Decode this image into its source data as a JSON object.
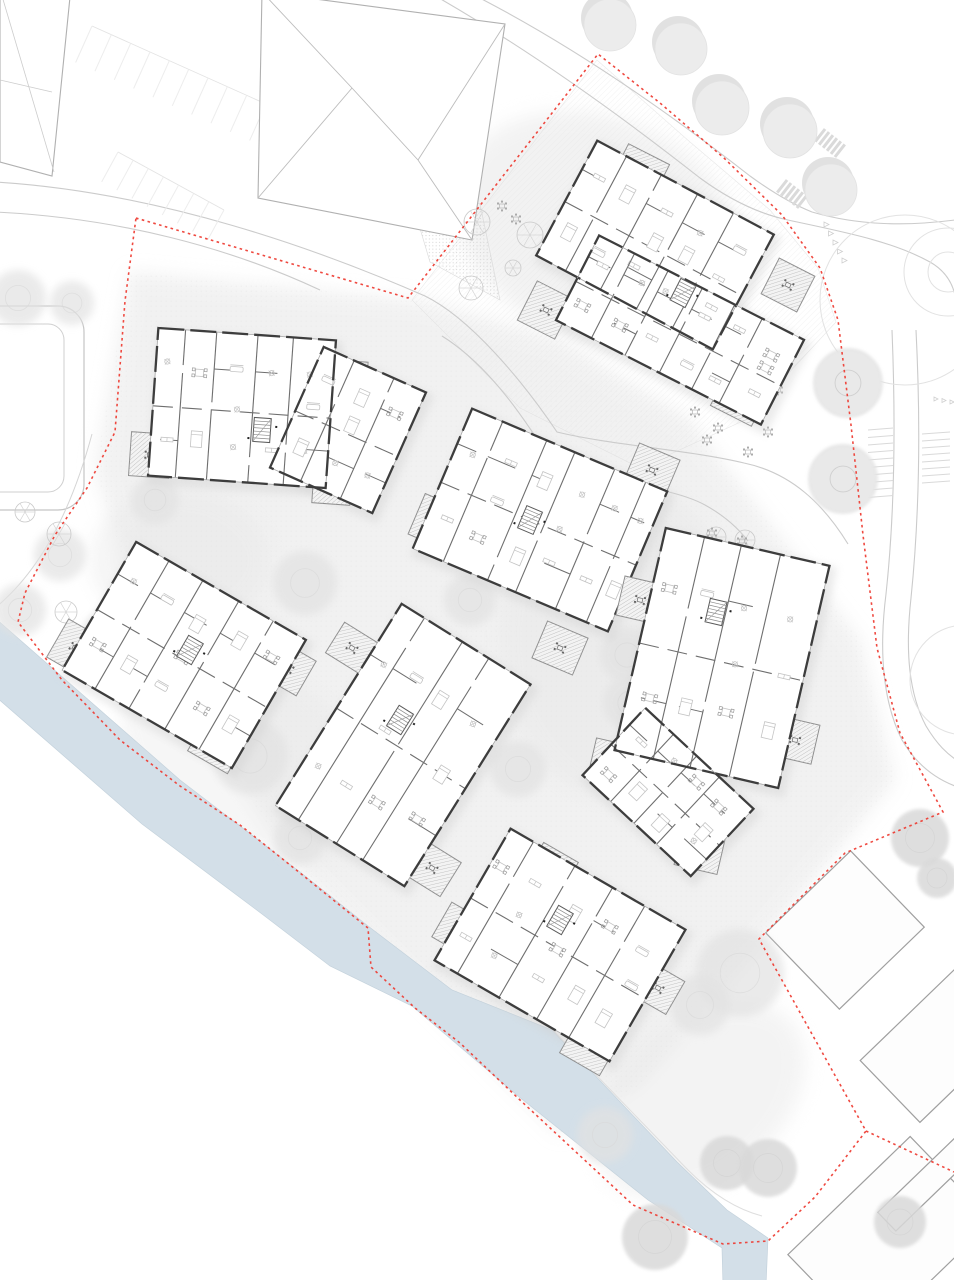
{
  "meta": {
    "title": "Residential quarter site plan – ground floor",
    "canvas": {
      "w": 954,
      "h": 1280
    }
  },
  "palette": {
    "bg": "#ffffff",
    "wash": "#e9e9e9",
    "road": "#cbcbcb",
    "faint": "#e3e3e3",
    "context": "#a3a3a3",
    "wall": "#3d3d3d",
    "partition": "#6e6e6e",
    "window": "#a5a5a5",
    "furniture": "#c4c4c4",
    "chair": "#9a9a9a",
    "balcony_hatch": "#b7b7b7",
    "balcony_edge": "#8f8f8f",
    "boundary": "#ee3a30",
    "canal": "#d3dfe8",
    "canal_edge": "#c4d2dc",
    "tree_row": "#ececec",
    "tree_shadow": "#d9d9d9",
    "tree_fluffy": "#e2e2e2",
    "tree_solid": "#d9d9d9",
    "tree_line": "#c9c9c9"
  },
  "boundary": {
    "points": [
      [
        136,
        218
      ],
      [
        408,
        298
      ],
      [
        598,
        54
      ],
      [
        660,
        103
      ],
      [
        724,
        158
      ],
      [
        782,
        215
      ],
      [
        820,
        268
      ],
      [
        838,
        320
      ],
      [
        851,
        425
      ],
      [
        863,
        535
      ],
      [
        877,
        648
      ],
      [
        900,
        733
      ],
      [
        930,
        788
      ],
      [
        943,
        812
      ],
      [
        845,
        853
      ],
      [
        759,
        939
      ],
      [
        866,
        1131
      ],
      [
        815,
        1197
      ],
      [
        768,
        1241
      ],
      [
        723,
        1244
      ],
      [
        633,
        1205
      ],
      [
        520,
        1100
      ],
      [
        460,
        1043
      ],
      [
        415,
        1008
      ],
      [
        371,
        967
      ],
      [
        368,
        928
      ],
      [
        300,
        873
      ],
      [
        240,
        825
      ],
      [
        180,
        786
      ],
      [
        120,
        740
      ],
      [
        62,
        680
      ],
      [
        18,
        622
      ],
      [
        25,
        593
      ],
      [
        55,
        535
      ],
      [
        87,
        488
      ],
      [
        115,
        432
      ],
      [
        125,
        301
      ]
    ],
    "extra_segments": [
      [
        [
          866,
          1131
        ],
        [
          954,
          1172
        ]
      ]
    ]
  },
  "canal": {
    "points": [
      [
        -5,
        618
      ],
      [
        180,
        780
      ],
      [
        300,
        872
      ],
      [
        368,
        926
      ],
      [
        452,
        990
      ],
      [
        552,
        1030
      ],
      [
        677,
        1162
      ],
      [
        727,
        1210
      ],
      [
        768,
        1238
      ],
      [
        766,
        1285
      ],
      [
        723,
        1285
      ],
      [
        722,
        1248
      ],
      [
        648,
        1200
      ],
      [
        518,
        1096
      ],
      [
        412,
        1006
      ],
      [
        330,
        966
      ],
      [
        262,
        914
      ],
      [
        142,
        824
      ],
      [
        -5,
        696
      ]
    ],
    "path_edge": "M545,1022 L688,1170 Q724,1206 762,1216"
  },
  "wash": {
    "main": [
      [
        130,
        272
      ],
      [
        420,
        300
      ],
      [
        560,
        340
      ],
      [
        690,
        420
      ],
      [
        860,
        640
      ],
      [
        895,
        780
      ],
      [
        770,
        935
      ],
      [
        640,
        1085
      ],
      [
        560,
        1135
      ],
      [
        430,
        1005
      ],
      [
        300,
        875
      ],
      [
        150,
        645
      ],
      [
        95,
        470
      ]
    ],
    "patches": [
      {
        "cx": 250,
        "cy": 760,
        "rx": 140,
        "ry": 90,
        "rot": 30,
        "op": 0.35
      },
      {
        "cx": 620,
        "cy": 640,
        "rx": 120,
        "ry": 160,
        "rot": 0,
        "op": 0.4
      },
      {
        "cx": 700,
        "cy": 1100,
        "rx": 120,
        "ry": 80,
        "rot": -40,
        "op": 0.45
      },
      {
        "cx": 180,
        "cy": 560,
        "rx": 90,
        "ry": 70,
        "rot": 0,
        "op": 0.4
      },
      {
        "cx": 600,
        "cy": 230,
        "rx": 150,
        "ry": 110,
        "rot": 25,
        "op": 0.5
      }
    ]
  },
  "garden_yard": [
    [
      412,
      300
    ],
    [
      597,
      60
    ],
    [
      690,
      142
    ],
    [
      770,
      210
    ],
    [
      818,
      268
    ],
    [
      836,
      322
    ],
    [
      745,
      420
    ],
    [
      640,
      468
    ],
    [
      520,
      408
    ]
  ],
  "gravel_strip": [
    [
      402,
      168
    ],
    [
      480,
      204
    ],
    [
      500,
      300
    ],
    [
      430,
      262
    ]
  ],
  "roads": [
    "M-5,182 C160,192 320,250 425,296 C470,318 522,380 557,432 C610,445 690,450 744,463 C792,473 824,505 848,544",
    "M-5,212 C120,218 230,248 320,290",
    "M442,336 C490,366 526,420 558,472 C612,483 672,487 705,505 C725,516 738,528 748,541",
    "M892,330 C896,430 894,520 886,594 C879,650 882,700 902,740 C916,764 934,778 955,786",
    "M916,330 C921,430 919,520 911,598 C905,652 909,694 926,726 C938,746 948,754 955,759",
    "M472,-6 C570,44 668,112 750,176 C772,192 792,204 812,212 C860,226 908,226 955,220",
    "M432,-6 C530,50 620,115 700,178 C730,200 760,214 788,220 C838,231 890,240 930,262 C944,270 952,282 955,295"
  ],
  "parking": {
    "east_left": {
      "x0": 868,
      "y0": 430,
      "x1": 893,
      "y1": 428,
      "count": 10,
      "step": 7.5
    },
    "east_right": {
      "x0": 922,
      "y0": 434,
      "x1": 950,
      "y1": 432,
      "count": 8,
      "step": 7
    },
    "northwest": [
      {
        "ax": 92,
        "ay": 26,
        "bx": 266,
        "by": 104,
        "count": 9,
        "len": 40
      },
      {
        "ax": 118,
        "ay": 152,
        "bx": 224,
        "by": 210,
        "count": 7,
        "len": 34
      }
    ]
  },
  "crosswalks": [
    {
      "cx": 830,
      "cy": 143,
      "rot": 38,
      "count": 6,
      "len": 16,
      "gap": 5
    },
    {
      "cx": 792,
      "cy": 194,
      "rot": 38,
      "count": 6,
      "len": 16,
      "gap": 5
    }
  ],
  "yield_rows": [
    {
      "x0": 824,
      "y0": 222,
      "x1": 842,
      "y1": 258,
      "count": 5,
      "size": 5
    },
    {
      "x0": 934,
      "y0": 397,
      "x1": 950,
      "y1": 400,
      "count": 3,
      "size": 4
    }
  ],
  "roundabout": {
    "circles": [
      {
        "cx": 948,
        "cy": 272,
        "r": 44
      },
      {
        "cx": 948,
        "cy": 272,
        "r": 20
      },
      {
        "cx": 905,
        "cy": 300,
        "r": 85
      },
      {
        "cx": 965,
        "cy": 680,
        "r": 55
      }
    ]
  },
  "sports_court": {
    "outer": {
      "x": -52,
      "y": 306,
      "w": 136,
      "h": 204,
      "rx": 26
    },
    "inner": {
      "x": -36,
      "y": 324,
      "w": 100,
      "h": 168,
      "rx": 16
    },
    "arc": "M-10,612 Q58,560 92,434"
  },
  "house": {
    "outline": [
      [
        262,
        -8
      ],
      [
        505,
        24
      ],
      [
        472,
        240
      ],
      [
        258,
        198
      ]
    ],
    "ridge": [
      [
        352,
        88
      ],
      [
        418,
        160
      ]
    ],
    "hips": [
      [
        [
          262,
          -8
        ],
        [
          352,
          88
        ]
      ],
      [
        [
          258,
          198
        ],
        [
          352,
          88
        ]
      ],
      [
        [
          505,
          24
        ],
        [
          418,
          160
        ]
      ],
      [
        [
          472,
          240
        ],
        [
          418,
          160
        ]
      ]
    ]
  },
  "corner_building": {
    "outline": [
      [
        0,
        -6
      ],
      [
        70,
        -3
      ],
      [
        52,
        176
      ],
      [
        0,
        162
      ]
    ],
    "lines": [
      [
        [
          2,
          -4
        ],
        [
          54,
          172
        ]
      ],
      [
        [
          0,
          80
        ],
        [
          52,
          92
        ]
      ]
    ]
  },
  "context_se": [
    {
      "cx": 845,
      "cy": 930,
      "w": 118,
      "h": 106,
      "rot": -44
    },
    {
      "cx": 962,
      "cy": 1022,
      "w": 200,
      "h": 86,
      "rot": -44
    },
    {
      "cx": 890,
      "cy": 1238,
      "w": 170,
      "h": 118,
      "rot": -44
    },
    {
      "cx": 930,
      "cy": 1180,
      "w": 120,
      "h": 26,
      "rot": -44
    }
  ],
  "trees": {
    "row": [
      [
        610,
        25,
        26
      ],
      [
        681,
        49,
        26
      ],
      [
        722,
        108,
        27
      ],
      [
        790,
        131,
        27
      ],
      [
        831,
        190,
        26
      ]
    ],
    "ring": [
      [
        848,
        383,
        34
      ],
      [
        843,
        479,
        34
      ]
    ],
    "fluffy": [
      [
        305,
        583,
        32
      ],
      [
        470,
        600,
        26
      ],
      [
        250,
        756,
        38
      ],
      [
        300,
        838,
        26
      ],
      [
        627,
        655,
        27
      ],
      [
        630,
        703,
        27
      ],
      [
        518,
        769,
        28
      ],
      [
        445,
        698,
        20
      ],
      [
        740,
        973,
        44
      ],
      [
        700,
        1005,
        30
      ],
      [
        605,
        1135,
        28
      ],
      [
        155,
        500,
        24
      ],
      [
        60,
        555,
        26
      ],
      [
        20,
        610,
        26
      ],
      [
        110,
        640,
        30
      ],
      [
        18,
        298,
        28
      ],
      [
        72,
        303,
        22
      ]
    ],
    "solid": [
      [
        655,
        1237,
        33
      ],
      [
        900,
        1222,
        26
      ],
      [
        920,
        838,
        29
      ],
      [
        937,
        878,
        20
      ],
      [
        727,
        1163,
        27
      ],
      [
        768,
        1168,
        29
      ]
    ],
    "line": [
      [
        530,
        235,
        13
      ],
      [
        477,
        222,
        13
      ],
      [
        471,
        288,
        12
      ],
      [
        513,
        268,
        8
      ],
      [
        716,
        537,
        10
      ],
      [
        745,
        540,
        10
      ],
      [
        59,
        534,
        12
      ],
      [
        25,
        512,
        10
      ],
      [
        66,
        612,
        11
      ]
    ]
  },
  "picnic_tables": [
    [
      695,
      412
    ],
    [
      718,
      428
    ],
    [
      737,
      372
    ],
    [
      768,
      432
    ],
    [
      748,
      452
    ],
    [
      628,
      492
    ],
    [
      502,
      206
    ],
    [
      516,
      219
    ],
    [
      712,
      533
    ],
    [
      742,
      541
    ],
    [
      778,
      390
    ],
    [
      707,
      440
    ]
  ],
  "buildings": [
    {
      "id": "north-east",
      "seed": 11,
      "volumes": [
        {
          "cx": 655,
          "cy": 245,
          "w": 200,
          "h": 130,
          "rot": 28
        },
        {
          "cx": 680,
          "cy": 330,
          "w": 230,
          "h": 95,
          "rot": 27
        }
      ],
      "balconies": [
        [
          640,
          172,
          46,
          40
        ],
        [
          546,
          310,
          42,
          44
        ],
        [
          788,
          285,
          40,
          40
        ],
        [
          740,
          398,
          46,
          40
        ]
      ],
      "stair": [
        683,
        293
      ],
      "rot": 27
    },
    {
      "id": "north-west",
      "seed": 23,
      "volumes": [
        {
          "cx": 242,
          "cy": 408,
          "w": 178,
          "h": 148,
          "rot": 4
        },
        {
          "cx": 348,
          "cy": 430,
          "w": 112,
          "h": 132,
          "rot": 24
        }
      ],
      "balconies": [
        [
          150,
          455,
          40,
          44
        ],
        [
          264,
          452,
          42,
          38
        ],
        [
          332,
          486,
          38,
          36
        ],
        [
          350,
          377,
          34,
          32
        ]
      ],
      "stair": [
        262,
        430
      ],
      "rot": 4
    },
    {
      "id": "centre",
      "seed": 37,
      "volumes": [
        {
          "cx": 540,
          "cy": 520,
          "w": 212,
          "h": 152,
          "rot": 23
        }
      ],
      "balconies": [
        [
          436,
          522,
          42,
          44
        ],
        [
          560,
          648,
          44,
          40
        ],
        [
          652,
          470,
          44,
          40
        ]
      ],
      "stair": [
        530,
        520
      ],
      "rot": 23
    },
    {
      "id": "west",
      "seed": 41,
      "volumes": [
        {
          "cx": 184,
          "cy": 655,
          "w": 196,
          "h": 148,
          "rot": 30
        }
      ],
      "balconies": [
        [
          75,
          648,
          40,
          44
        ],
        [
          140,
          580,
          38,
          36
        ],
        [
          218,
          744,
          46,
          42
        ],
        [
          288,
          668,
          42,
          40
        ]
      ],
      "stair": [
        190,
        650
      ],
      "rot": 30
    },
    {
      "id": "centre-south",
      "seed": 53,
      "volumes": [
        {
          "cx": 403,
          "cy": 745,
          "w": 152,
          "h": 238,
          "rot": 32
        }
      ],
      "balconies": [
        [
          352,
          648,
          40,
          36
        ],
        [
          470,
          700,
          38,
          36
        ],
        [
          330,
          800,
          40,
          38
        ],
        [
          432,
          868,
          44,
          40
        ]
      ],
      "stair": [
        400,
        720
      ],
      "rot": 32
    },
    {
      "id": "east",
      "seed": 67,
      "volumes": [
        {
          "cx": 722,
          "cy": 658,
          "w": 168,
          "h": 228,
          "rot": 13
        },
        {
          "cx": 668,
          "cy": 792,
          "w": 148,
          "h": 92,
          "rot": 43
        }
      ],
      "balconies": [
        [
          700,
          560,
          42,
          38
        ],
        [
          640,
          600,
          40,
          40
        ],
        [
          795,
          740,
          42,
          40
        ],
        [
          612,
          760,
          40,
          36
        ],
        [
          700,
          850,
          44,
          40
        ]
      ],
      "stair": [
        716,
        612
      ],
      "rot": 13
    },
    {
      "id": "south",
      "seed": 79,
      "volumes": [
        {
          "cx": 560,
          "cy": 945,
          "w": 202,
          "h": 152,
          "rot": 30
        }
      ],
      "balconies": [
        [
          552,
          868,
          40,
          36
        ],
        [
          460,
          930,
          42,
          40
        ],
        [
          590,
          1046,
          46,
          42
        ],
        [
          658,
          988,
          40,
          38
        ]
      ],
      "stair": [
        560,
        920
      ],
      "rot": 30
    }
  ]
}
